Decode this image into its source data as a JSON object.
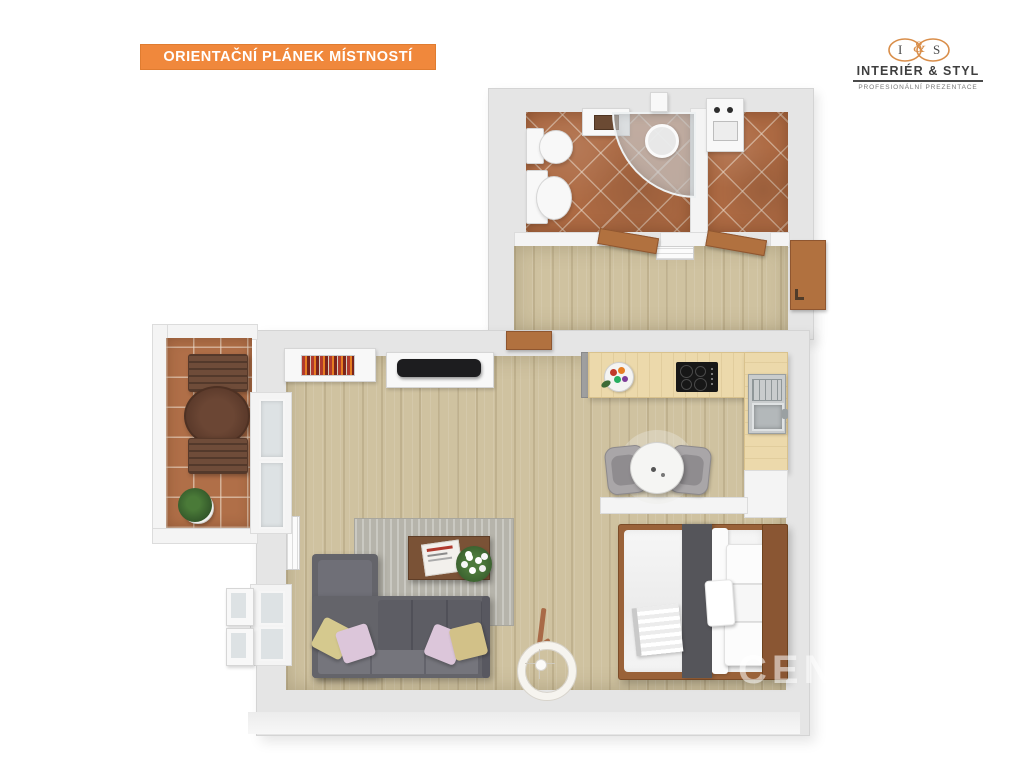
{
  "banner": {
    "label": "ORIENTAČNÍ PLÁNEK MÍSTNOSTÍ",
    "bg_color": "#F0883C",
    "text_color": "#FFFFFF"
  },
  "logo": {
    "monogram_i": "I",
    "monogram_amp": "&",
    "monogram_s": "S",
    "title": "INTERIÉR & STYL",
    "subtitle": "PROFESIONÁLNÍ PREZENTACE",
    "accent_color": "#D98E4A",
    "text_color": "#3F3F3F"
  },
  "watermark": {
    "text": "CENT",
    "color": "#FFFFFF"
  },
  "colors": {
    "wall": "#E5E5E5",
    "wood_floor": "#CFC2A0",
    "kitchen_counter": "#ECD9AB",
    "terracotta_tile": "#AD6A43",
    "balcony_tile": "#B06F48",
    "sofa_gray": "#64646A",
    "rug_gray": "#B6B4AB",
    "bed_runner": "#55555A",
    "door_brown": "#B1713F",
    "headboard_brown": "#8A5633"
  }
}
